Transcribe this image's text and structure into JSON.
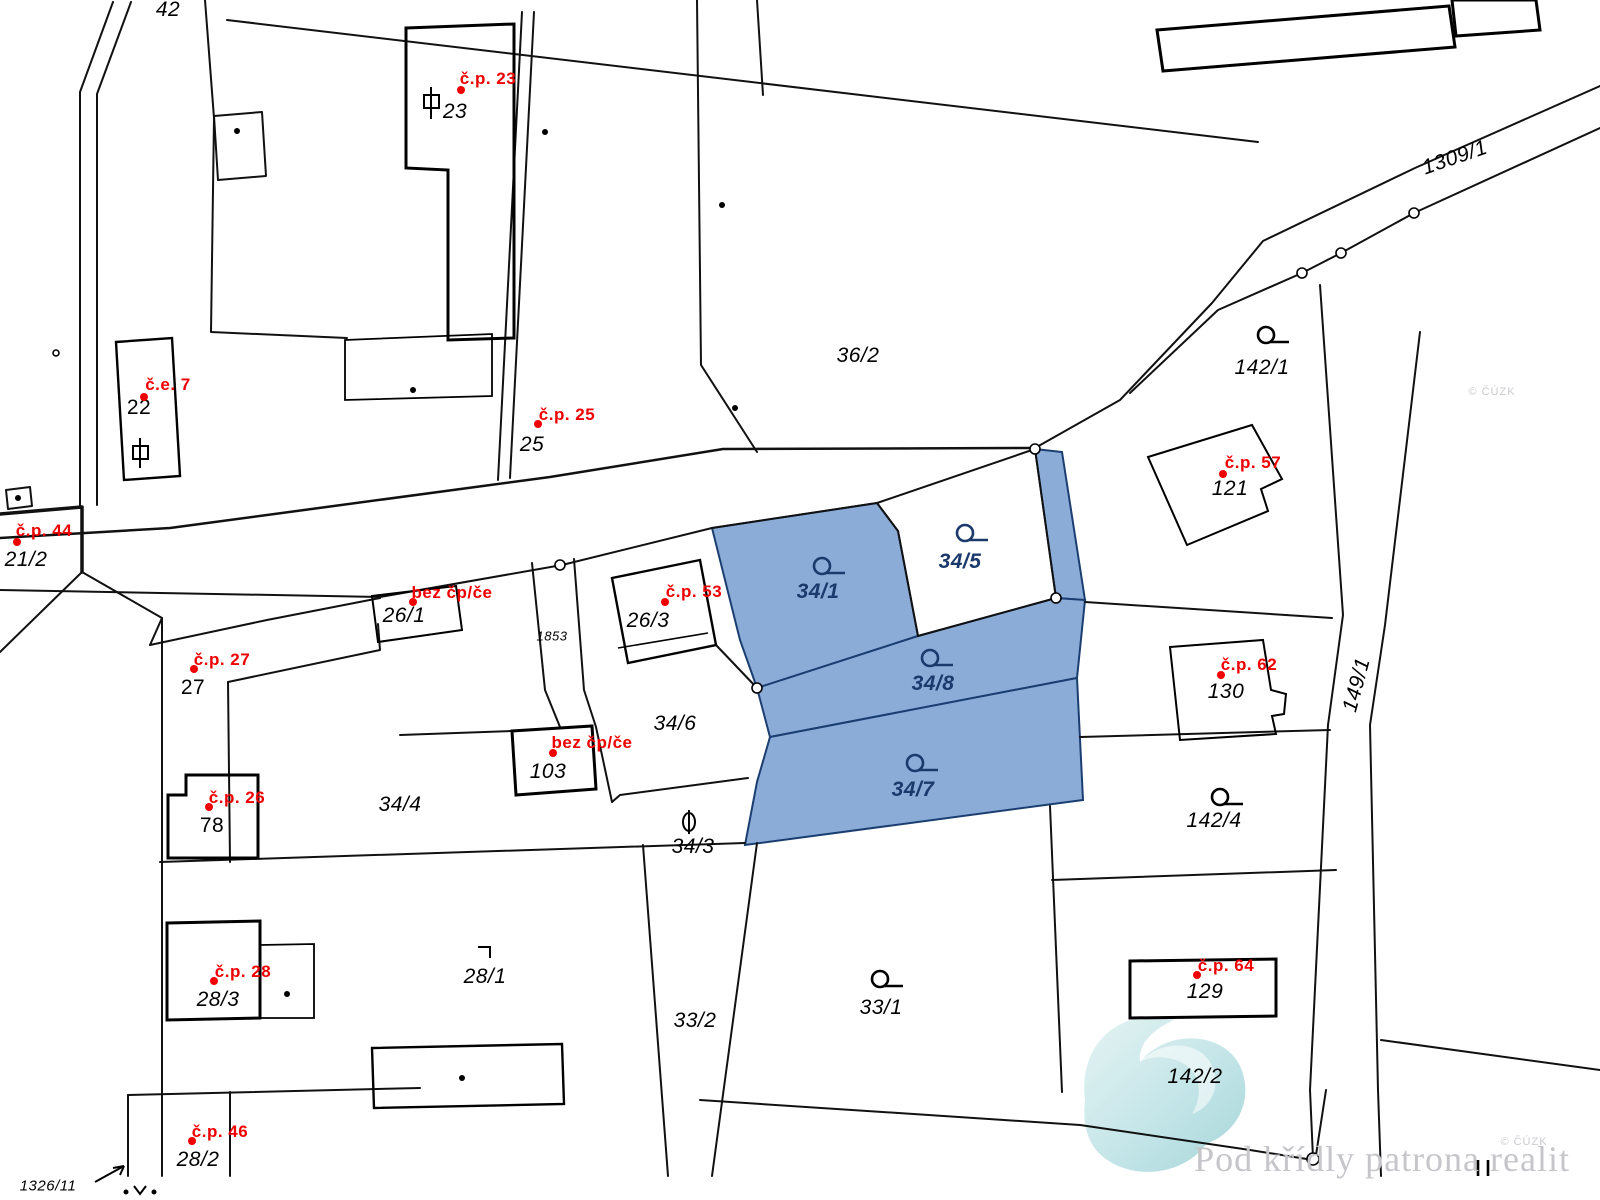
{
  "map": {
    "type": "cadastral-map",
    "highlight_color": "#8cacd8",
    "navy_label_color": "#1b3a6c",
    "line_color": "#000000",
    "red_label_color": "#f00000",
    "highlighted_parcels": [
      "34/1",
      "34/8",
      "34/7"
    ],
    "parcel_labels": [
      {
        "text": "42",
        "x": 168,
        "y": 10
      },
      {
        "text": "23",
        "x": 455,
        "y": 112
      },
      {
        "text": "22",
        "x": 139,
        "y": 408,
        "cls": "upright"
      },
      {
        "text": "21/2",
        "x": 26,
        "y": 560
      },
      {
        "text": "25",
        "x": 532,
        "y": 445
      },
      {
        "text": "36/2",
        "x": 858,
        "y": 356
      },
      {
        "text": "1309/1",
        "x": 1455,
        "y": 158,
        "rot": -19
      },
      {
        "text": "26/1",
        "x": 404,
        "y": 616
      },
      {
        "text": "1853",
        "x": 552,
        "y": 636,
        "cls": "small"
      },
      {
        "text": "26/3",
        "x": 648,
        "y": 621
      },
      {
        "text": "27",
        "x": 193,
        "y": 688,
        "cls": "upright"
      },
      {
        "text": "34/6",
        "x": 675,
        "y": 724
      },
      {
        "text": "103",
        "x": 548,
        "y": 772
      },
      {
        "text": "34/4",
        "x": 400,
        "y": 805
      },
      {
        "text": "78",
        "x": 212,
        "y": 826,
        "cls": "upright"
      },
      {
        "text": "34/3",
        "x": 693,
        "y": 847
      },
      {
        "text": "34/1",
        "x": 818,
        "y": 592,
        "cls": "navy"
      },
      {
        "text": "34/5",
        "x": 960,
        "y": 562,
        "cls": "navy"
      },
      {
        "text": "34/8",
        "x": 933,
        "y": 684,
        "cls": "navy"
      },
      {
        "text": "34/7",
        "x": 913,
        "y": 790,
        "cls": "navy"
      },
      {
        "text": "142/1",
        "x": 1262,
        "y": 368
      },
      {
        "text": "121",
        "x": 1230,
        "y": 489
      },
      {
        "text": "130",
        "x": 1226,
        "y": 692
      },
      {
        "text": "149/1",
        "x": 1357,
        "y": 685,
        "rot": -75
      },
      {
        "text": "142/4",
        "x": 1214,
        "y": 821
      },
      {
        "text": "129",
        "x": 1205,
        "y": 992
      },
      {
        "text": "142/2",
        "x": 1195,
        "y": 1077
      },
      {
        "text": "28/1",
        "x": 485,
        "y": 977
      },
      {
        "text": "28/3",
        "x": 218,
        "y": 1000
      },
      {
        "text": "33/2",
        "x": 695,
        "y": 1021
      },
      {
        "text": "33/1",
        "x": 881,
        "y": 1008
      },
      {
        "text": "28/2",
        "x": 198,
        "y": 1160
      },
      {
        "text": "1326/11",
        "x": 48,
        "y": 1186,
        "cls": "mid"
      }
    ],
    "house_labels": [
      {
        "text": "č.p. 23",
        "x": 488,
        "y": 79,
        "dx": 461,
        "dy": 90
      },
      {
        "text": "č.e. 7",
        "x": 168,
        "y": 385,
        "dx": 144,
        "dy": 397
      },
      {
        "text": "č.p. 44",
        "x": 44,
        "y": 531,
        "dx": 17,
        "dy": 542
      },
      {
        "text": "č.p. 25",
        "x": 567,
        "y": 415,
        "dx": 538,
        "dy": 424
      },
      {
        "text": "bez čp/če",
        "x": 452,
        "y": 593,
        "dx": 413,
        "dy": 602
      },
      {
        "text": "č.p. 53",
        "x": 694,
        "y": 592,
        "dx": 665,
        "dy": 602
      },
      {
        "text": "č.p. 27",
        "x": 222,
        "y": 660,
        "dx": 194,
        "dy": 669
      },
      {
        "text": "bez čp/če",
        "x": 592,
        "y": 743,
        "dx": 553,
        "dy": 753
      },
      {
        "text": "č.p. 26",
        "x": 237,
        "y": 798,
        "dx": 209,
        "dy": 807
      },
      {
        "text": "č.p. 28",
        "x": 243,
        "y": 972,
        "dx": 214,
        "dy": 981
      },
      {
        "text": "č.p. 46",
        "x": 220,
        "y": 1132,
        "dx": 192,
        "dy": 1141
      },
      {
        "text": "č.p. 57",
        "x": 1253,
        "y": 463,
        "dx": 1223,
        "dy": 474
      },
      {
        "text": "č.p. 62",
        "x": 1249,
        "y": 665,
        "dx": 1221,
        "dy": 675
      },
      {
        "text": "č.p. 64",
        "x": 1226,
        "y": 966,
        "dx": 1197,
        "dy": 975
      }
    ],
    "gray_labels": [
      {
        "text": "© ČÚZK",
        "x": 1492,
        "y": 392
      },
      {
        "text": "© ČÚZK",
        "x": 1524,
        "y": 1142
      }
    ]
  },
  "watermark": {
    "text": "Pod křídly patrona realit"
  }
}
